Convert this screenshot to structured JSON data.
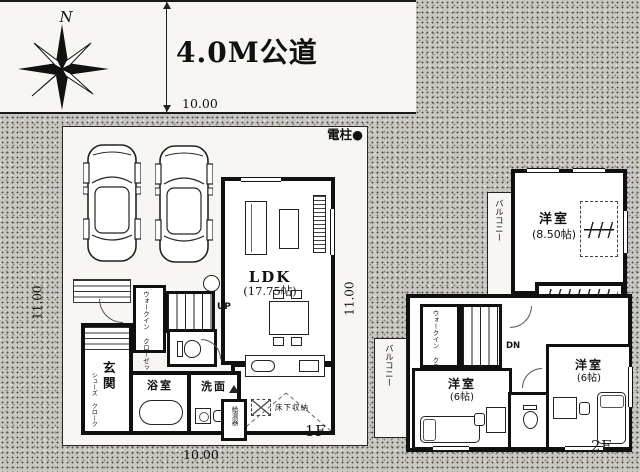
{
  "site": {
    "north_label": "N",
    "road_label": "4.0M公道",
    "road_frontage_dim": "10.00",
    "utility_pole_label": "電柱●",
    "lot_width_dim": "10.00",
    "lot_depth_dim_left": "11.00",
    "lot_depth_dim_right": "11.00"
  },
  "floor1": {
    "floor_label": "1F",
    "ldk_label": "LDK",
    "ldk_size": "(17.75帖)",
    "entrance_label": "玄関",
    "shoes_closet_line1": "シューズ",
    "shoes_closet_line2": "クローク",
    "bathroom_label": "浴室",
    "washroom_label": "洗面",
    "wic_line1": "ウォークイン",
    "wic_line2": "クローゼット",
    "stairs_label": "UP",
    "underfloor_label": "床下収納",
    "water_heater_label": "給湯器"
  },
  "floor2": {
    "floor_label": "2F",
    "main_bedroom_label": "洋室",
    "main_bedroom_size": "(8.50帖)",
    "bedroom2_label": "洋室",
    "bedroom2_size": "(6帖)",
    "bedroom3_label": "洋室",
    "bedroom3_size": "(6帖)",
    "balcony_upper_label": "バルコニー",
    "balcony_lower_label": "バルコニー",
    "wic_line1": "ウォークイン",
    "wic_line2": "クローゼット",
    "stairs_label": "DN"
  }
}
